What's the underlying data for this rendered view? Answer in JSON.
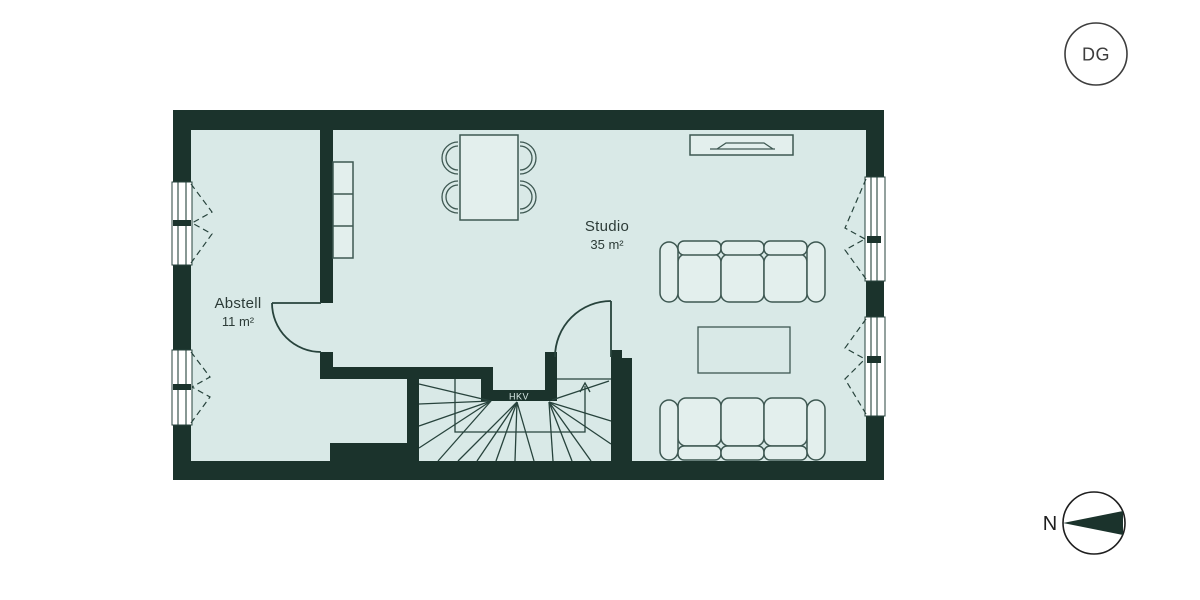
{
  "floor_badge": {
    "label": "DG"
  },
  "compass": {
    "north_label": "N"
  },
  "rooms": {
    "abstell": {
      "name": "Abstell",
      "area": "11 m²"
    },
    "studio": {
      "name": "Studio",
      "area": "35 m²"
    }
  },
  "annotations": {
    "hkv_label": "HKV"
  },
  "colors": {
    "wall": "#1b332c",
    "floor": "#d9e9e7",
    "window-fill": "#ffffff",
    "furniture-fill": "#e3efed",
    "furniture-stroke": "#3e5852",
    "line": "#27433c",
    "text": "#2c3b37",
    "badge": "#3d3d3d",
    "compass-ink": "#1e1e1e",
    "page-bg": "#ffffff"
  }
}
